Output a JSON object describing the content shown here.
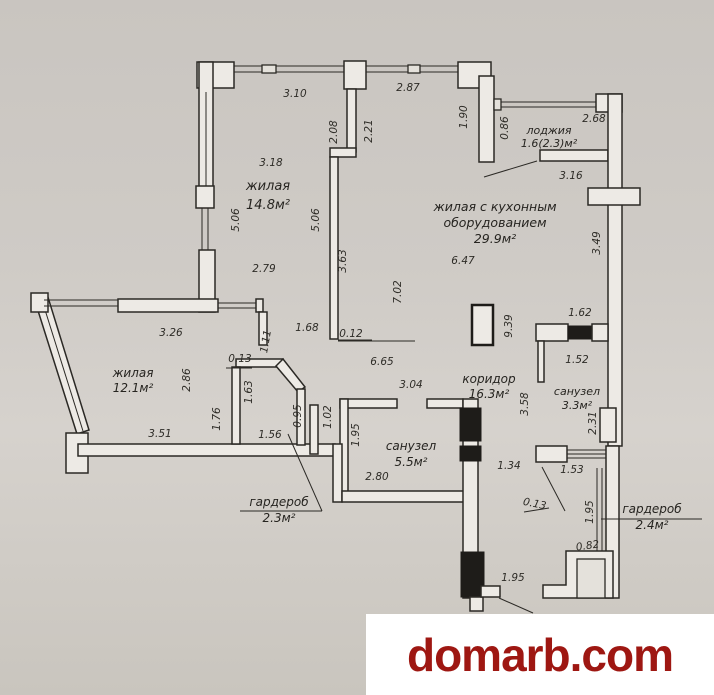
{
  "watermark": {
    "text": "domarb.com",
    "color": "#9e1712"
  },
  "plan": {
    "rooms": [
      {
        "lines": [
          "жилая",
          "14.8м²"
        ],
        "x": 268,
        "y": 190,
        "fs": 13,
        "lh": 19
      },
      {
        "lines": [
          "жилая с кухонным",
          "оборудованием",
          "29.9м²"
        ],
        "x": 495,
        "y": 211,
        "fs": 12.5,
        "lh": 16
      },
      {
        "lines": [
          "лоджия",
          "1.6(2.3)м²"
        ],
        "x": 549,
        "y": 134,
        "fs": 11,
        "lh": 13
      },
      {
        "lines": [
          "жилая",
          "12.1м²"
        ],
        "x": 133,
        "y": 377,
        "fs": 12,
        "lh": 15
      },
      {
        "lines": [
          "коридор",
          "16.3м²"
        ],
        "x": 489,
        "y": 383,
        "fs": 12,
        "lh": 15
      },
      {
        "lines": [
          "санузел",
          "5.5м²"
        ],
        "x": 411,
        "y": 450,
        "fs": 12,
        "lh": 16
      },
      {
        "lines": [
          "санузел",
          "3.3м²"
        ],
        "x": 577,
        "y": 395,
        "fs": 11,
        "lh": 14
      },
      {
        "lines": [
          "гардероб",
          "2.3м²"
        ],
        "x": 279,
        "y": 506,
        "fs": 12,
        "lh": 16
      },
      {
        "lines": [
          "гардероб",
          "2.4м²"
        ],
        "x": 652,
        "y": 513,
        "fs": 12,
        "lh": 16
      }
    ],
    "dimensions": [
      {
        "t": "3.10",
        "x": 295,
        "y": 97
      },
      {
        "t": "2.87",
        "x": 408,
        "y": 91
      },
      {
        "t": "2.08",
        "x": 337,
        "y": 132,
        "r": -90
      },
      {
        "t": "2.21",
        "x": 372,
        "y": 131,
        "r": -90
      },
      {
        "t": "1.90",
        "x": 467,
        "y": 117,
        "r": -90
      },
      {
        "t": "0.86",
        "x": 508,
        "y": 128,
        "r": -90
      },
      {
        "t": "2.68",
        "x": 594,
        "y": 122
      },
      {
        "t": "3.18",
        "x": 271,
        "y": 166
      },
      {
        "t": "3.16",
        "x": 571,
        "y": 179
      },
      {
        "t": "5.06",
        "x": 239,
        "y": 220,
        "r": -90
      },
      {
        "t": "5.06",
        "x": 319,
        "y": 220,
        "r": -90
      },
      {
        "t": "3.49",
        "x": 600,
        "y": 243,
        "r": -90
      },
      {
        "t": "2.79",
        "x": 264,
        "y": 272
      },
      {
        "t": "3.63",
        "x": 346,
        "y": 261,
        "r": -90
      },
      {
        "t": "7.02",
        "x": 401,
        "y": 292,
        "r": -90
      },
      {
        "t": "6.47",
        "x": 463,
        "y": 264
      },
      {
        "t": "3.26",
        "x": 171,
        "y": 336
      },
      {
        "t": "1.11",
        "x": 269,
        "y": 342,
        "r": -80
      },
      {
        "t": "0.13",
        "x": 240,
        "y": 362
      },
      {
        "t": "1.68",
        "x": 307,
        "y": 331
      },
      {
        "t": "0.12",
        "x": 351,
        "y": 337
      },
      {
        "t": "6.65",
        "x": 382,
        "y": 365
      },
      {
        "t": "9.39",
        "x": 512,
        "y": 326,
        "r": -90
      },
      {
        "t": "1.62",
        "x": 580,
        "y": 316
      },
      {
        "t": "2.86",
        "x": 190,
        "y": 380,
        "r": -90
      },
      {
        "t": "1.63",
        "x": 252,
        "y": 392,
        "r": -90
      },
      {
        "t": "1.52",
        "x": 577,
        "y": 363
      },
      {
        "t": "3.04",
        "x": 411,
        "y": 388
      },
      {
        "t": "3.58",
        "x": 528,
        "y": 404,
        "r": -90
      },
      {
        "t": "1.76",
        "x": 220,
        "y": 419,
        "r": -90
      },
      {
        "t": "0.95",
        "x": 301,
        "y": 416,
        "r": -90
      },
      {
        "t": "1.02",
        "x": 331,
        "y": 417,
        "r": -90
      },
      {
        "t": "1.95",
        "x": 359,
        "y": 435,
        "r": -90
      },
      {
        "t": "2.31",
        "x": 596,
        "y": 423,
        "r": -90
      },
      {
        "t": "3.51",
        "x": 160,
        "y": 437
      },
      {
        "t": "1.56",
        "x": 270,
        "y": 438
      },
      {
        "t": "1.34",
        "x": 509,
        "y": 469
      },
      {
        "t": "2.80",
        "x": 377,
        "y": 480
      },
      {
        "t": "1.53",
        "x": 572,
        "y": 473
      },
      {
        "t": "0.13",
        "x": 534,
        "y": 507,
        "r": 12
      },
      {
        "t": "1.95",
        "x": 593,
        "y": 512,
        "r": -90
      },
      {
        "t": "0.82",
        "x": 588,
        "y": 549,
        "r": -8
      },
      {
        "t": "1.95",
        "x": 513,
        "y": 581
      }
    ]
  }
}
